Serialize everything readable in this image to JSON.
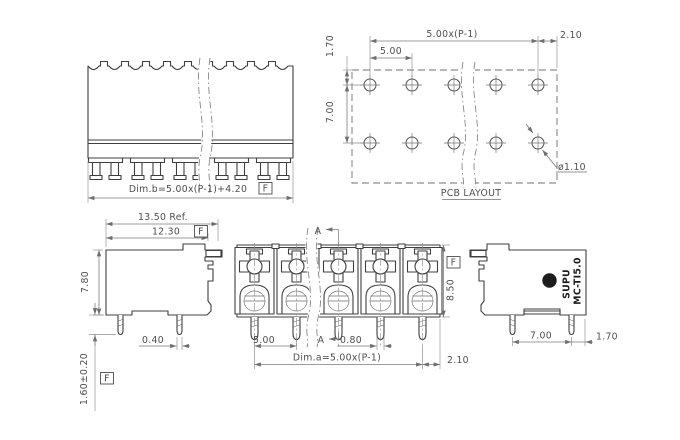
{
  "drawing": {
    "background": "#ffffff",
    "line_color": "#3f3f3f",
    "dim_color": "#7d7d7d",
    "text_color": "#4e4e4e",
    "datum_flag": "F",
    "top_view": {
      "dim_b": "Dim.b=5.00x(P-1)+4.20",
      "positions": 5
    },
    "pcb_layout": {
      "title": "PCB LAYOUT",
      "pitch_span": "5.00x(P-1)",
      "pitch": "5.00",
      "edge_margin": "2.10",
      "row_offset": "1.70",
      "row_pitch": "7.00",
      "hole_diameter": "ø1.10",
      "hole_grid": {
        "rows": 2,
        "columns": 5
      }
    },
    "side_view_left": {
      "ref_width": "13.50 Ref.",
      "front_width": "12.30",
      "height": "7.80",
      "pin_width": "0.40",
      "pin_length": "1.60±0.20"
    },
    "front_view": {
      "section_label": "A",
      "pitch": "5.00",
      "pin_width": "0.80",
      "dim_a": "Dim.a=5.00x(P-1)",
      "edge_margin": "2.10",
      "height": "8.50",
      "positions": 5
    },
    "side_view_right": {
      "brand": "SUPU",
      "brand_initial": "S",
      "model": "MC-TI5.0",
      "pin_span": "7.00",
      "pin_edge": "1.70"
    }
  }
}
